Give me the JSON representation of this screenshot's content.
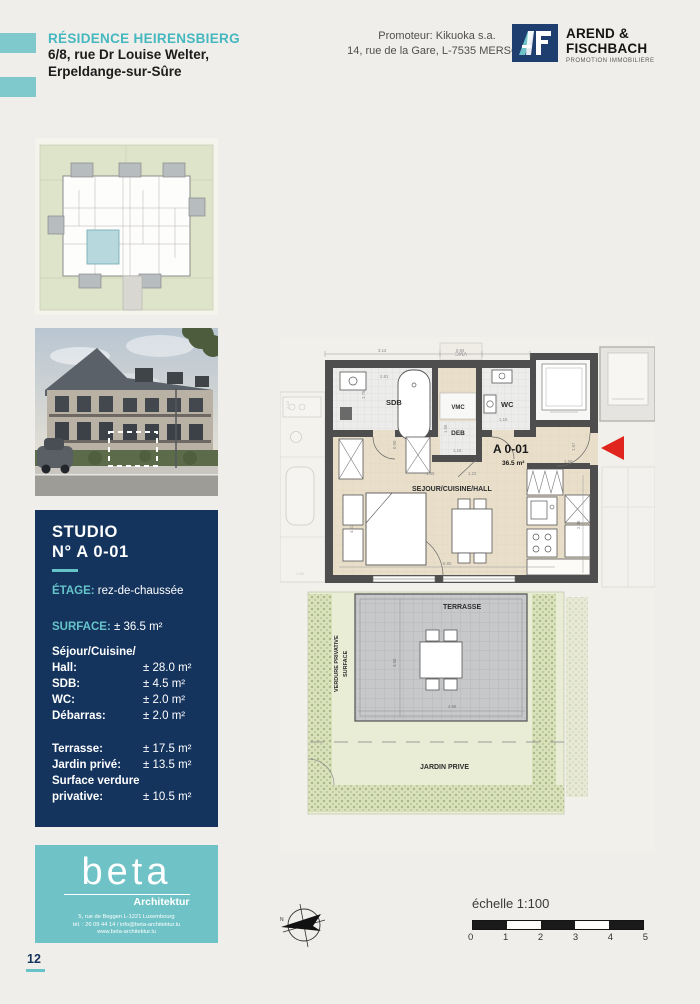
{
  "page": {
    "page_number": "12"
  },
  "header": {
    "residence_title": "RÉSIDENCE HEIRENSBIERG",
    "address_line1": "6/8, rue Dr Louise Welter,",
    "address_line2": "Erpeldange-sur-Sûre",
    "promoter_line1": "Promoteur: Kikuoka s.a.",
    "promoter_line2": "14, rue de la Gare, L-7535 MERSCH",
    "logo": {
      "line1": "AREND &",
      "line2": "FISCHBACH",
      "tagline": "PROMOTION IMMOBILIERE"
    }
  },
  "unit_info": {
    "title_line1": "STUDIO",
    "title_line2": "N° A 0-01",
    "etage_label": "ÉTAGE:",
    "etage_value": "rez-de-chaussée",
    "surface_label": "SURFACE:",
    "surface_value": "± 36.5 m²",
    "rooms": [
      {
        "label": "Séjour/Cuisine/",
        "value": ""
      },
      {
        "label": "Hall:",
        "value": "± 28.0 m²"
      },
      {
        "label": "SDB:",
        "value": "± 4.5 m²"
      },
      {
        "label": "WC:",
        "value": "± 2.0 m²"
      },
      {
        "label": "Débarras:",
        "value": "± 2.0 m²"
      }
    ],
    "outdoor": [
      {
        "label": "Terrasse:",
        "value": "± 17.5 m²"
      },
      {
        "label": "Jardin privé:",
        "value": "± 13.5 m²"
      },
      {
        "label": "Surface verdure",
        "value": ""
      },
      {
        "label": "privative:",
        "value": "± 10.5 m²"
      }
    ]
  },
  "architect": {
    "logo": "beta",
    "sub": "Architektur",
    "line1": "5, rue de Beggen L-1221 Luxembourg",
    "line2": "tél. : 26 09 44 14 / info@beta-architektur.lu",
    "line3": "www.beta-architektur.lu"
  },
  "floor_plan": {
    "unit_id": "A 0-01",
    "unit_area": "36.5 m²",
    "room_sdb": "SDB",
    "room_wc": "WC",
    "room_vmc": "VMC",
    "room_deb": "DEB",
    "room_sejour": "SEJOUR/CUISINE/HALL",
    "terrasse": "TERRASSE",
    "jardin": "JARDIN PRIVE",
    "verdure_line1": "SURFACE",
    "verdure_line2": "VERDURE PRIVATIVE",
    "neighbor_vmc": "VMC",
    "dimensions": [
      "3.12",
      "0.94",
      "2.81",
      "1.75",
      "1.18",
      "0.90",
      "1.55",
      "1.16",
      "1.39",
      "1.22",
      "1.67",
      "1.68",
      "6.80",
      "2.48",
      "4.22",
      "3.50",
      "4.96"
    ],
    "neighbor_dimensions": [
      "2.14",
      "1.54"
    ]
  },
  "scale_bar": {
    "label": "échelle 1:100",
    "ticks": [
      "0",
      "1",
      "2",
      "3",
      "4",
      "5"
    ]
  }
}
